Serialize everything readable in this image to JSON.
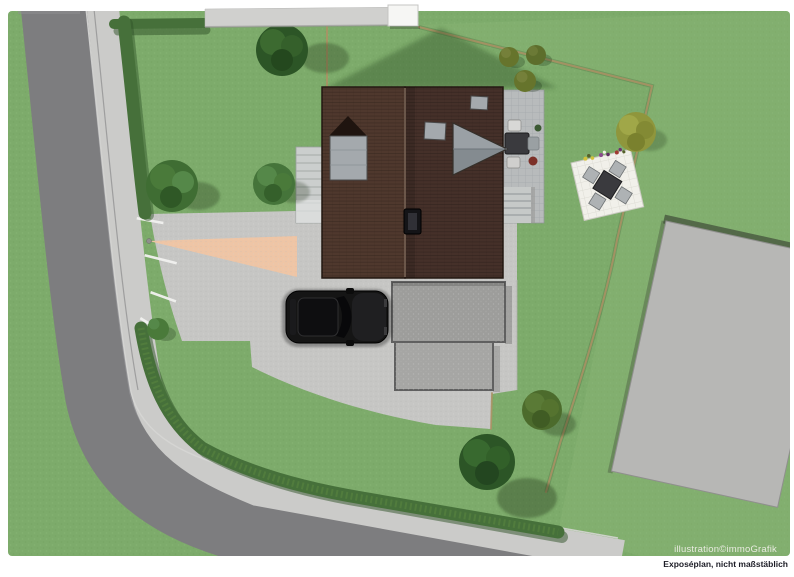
{
  "credits": {
    "illustration": "illustration©immoGrafik",
    "disclaimer": "Exposéplan, nicht maßstäblich"
  },
  "palette": {
    "white": "#ffffff",
    "lawn": "#7dab6b",
    "lawnTint": "#8eb87b",
    "road": "#7d7d7f",
    "sidewalk": "#cbcbc9",
    "pavement": "#c6c6c4",
    "salmon": "#efc5a5",
    "hedge": "#46703a",
    "hedgeDark": "#2f5128",
    "boundaryTan": "#ab9164",
    "roofLeft": "#4f382d",
    "roofRight": "#453029",
    "dormerGray": "#a4a9ad",
    "wingGray": "#9aa0a5",
    "wingGrayDark": "#848b90",
    "terrace": "#b8bbbc",
    "stepGray": "#c6c9c8",
    "padGray": "#9d9d9b",
    "padGray2": "#a6a6a4",
    "padEdge": "#606060",
    "carBody": "#151515",
    "patioWhite": "#f1f0ea",
    "tableDark": "#3a3a3e",
    "chairGray": "#aeb2b4",
    "buildingGray": "#b7b7b5",
    "buildingWhite": "#f6f6f4",
    "treeDark": "#2c5526",
    "treeGreen": "#3f6d33",
    "treeLight": "#558849",
    "treeOlive": "#75803a",
    "oliveYellow": "#8f963c",
    "flowerYellow": "#d2c23c",
    "flowerPurple": "#8a4a8e",
    "flowerRed": "#a03a32",
    "textLight": "#e9ebe0",
    "textDark": "#1c1c26"
  },
  "scene": {
    "objects": [
      "road",
      "sidewalk",
      "hedge",
      "lawn",
      "driveway-pavement",
      "salmon-footpath",
      "parking-markings",
      "house-roof",
      "roof-dormer",
      "roof-skylights",
      "gable-wing",
      "chimney",
      "entrance-steps",
      "terrace-with-seating",
      "terrace-steps",
      "garage-forecourt-pads",
      "parked-car",
      "garden-patio",
      "patio-table",
      "patio-chairs",
      "flower-boxes",
      "trees",
      "bushes",
      "neighbor-building",
      "neighbor-pavement",
      "boundary-lines",
      "house-shadow"
    ]
  }
}
